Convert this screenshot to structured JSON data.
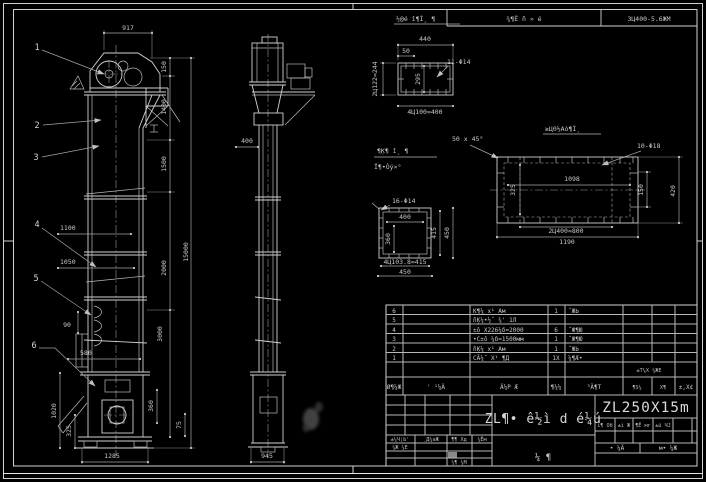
{
  "colors": {
    "background": "#000000",
    "line": "#d2d2d2",
    "dim_line": "#a5a5a5",
    "text": "#c8c8c8",
    "highlight_cell": "#8a8a8a",
    "smudge": "#4a4a4a"
  },
  "top_strip": {
    "cell1": "¾¶Ё ñ » é",
    "cell2": "3Ц400-5.6ЖМ"
  },
  "front_view": {
    "balloons": [
      "1",
      "2",
      "3",
      "4",
      "5",
      "6"
    ],
    "dims": {
      "w917": "917",
      "h150": "150",
      "h1400": "1400",
      "h1500": "1500",
      "h2000": "2000",
      "h3000": "3000",
      "total": "15000",
      "w1100": "1100",
      "w1050": "1050",
      "v90": "90",
      "w580": "580",
      "v1020": "1020",
      "v325": "325",
      "base": "1285",
      "v360": "360",
      "v75": "75"
    }
  },
  "side_view": {
    "dims": {
      "w400": "400",
      "base": "945"
    }
  },
  "detail_flange": {
    "title": "½@é î¶Ì¸ ¶",
    "holes": "11-Φ14",
    "note1": "¶Ķ¶ î¸ ¶",
    "note2": "Ï¶•Òý×°",
    "dims": {
      "top": "440",
      "offset": "50",
      "left": "2Ц122=244",
      "inner": "295",
      "bottom": "4Ц100=400"
    }
  },
  "detail_panel": {
    "title": "≥Ц0½Аò¶Ì¸",
    "holes": "10-Φ18",
    "chamfer": "50 x 45°",
    "dims": {
      "inner": "1098",
      "left": "325",
      "right1": "150",
      "right2": "420",
      "bottom1": "2Ц400=800",
      "bottom2": "1190"
    }
  },
  "detail_square": {
    "holes": "16-Φ14",
    "dims": {
      "inner_w": "400",
      "inner_h": "360",
      "right1": "415",
      "right2": "450",
      "bottom1": "4Ц103.8=415",
      "bottom2": "450"
    }
  },
  "parts_table": {
    "headers": {
      "seq": "Ø¶¼Ж",
      "code": "' ¹¼Ä",
      "name": "Ä¼Р Æ",
      "qty": "¶¼¼",
      "material": "³Ä¶Т",
      "weight_top": "±Т¼Х ¼ЖЕ",
      "weight_b1": "¶Ѕ¼",
      "weight_b2": "Х¶",
      "remark": "±,Х¢"
    },
    "rows": [
      {
        "seq": "6",
        "name": "Ķ¶¼ х¹ Ам",
        "qty": "1",
        "material": "˝ЖЬ"
      },
      {
        "seq": "5",
        "name": "ñĶ¼•½˝ ¾' 1Л",
        "qty": "",
        "material": ""
      },
      {
        "seq": "4",
        "name": "±ô Х226¼δ=2000",
        "qty": "6",
        "material": "˝Ж¶Ю"
      },
      {
        "seq": "3",
        "name": "•С±ô ¼δ=1500мм",
        "qty": "1",
        "material": "˝Ж¶Ю"
      },
      {
        "seq": "2",
        "name": "ñĶ¼ х¹ Ам",
        "qty": "1",
        "material": "˝ЖЬ"
      },
      {
        "seq": "1",
        "name": "СÄ¼˝ Х¹ ¶Д",
        "qty": "1Х",
        "material": "¼¶Æ•"
      }
    ]
  },
  "title_block": {
    "sig_headers": [
      "±¼Ч¦Ь'",
      "¸Д¼аЖ",
      "¶¶ Хд",
      "¼Ём"
    ],
    "sig_row2": "¼Ж ¼Е",
    "sig_row4": "¼¶ ¼М",
    "main_title": "ZL¶• ê½ì d é¼ú",
    "sub_chars": "¼   ¶",
    "model": "ZL250X15m",
    "info_labels": [
      "ì¶ Об",
      "±ì Ж",
      "¶Ё мг",
      "±ü ЧЈ"
    ],
    "bottom_left": "• ¼Ä",
    "bottom_right": "м• ¼Ж"
  }
}
